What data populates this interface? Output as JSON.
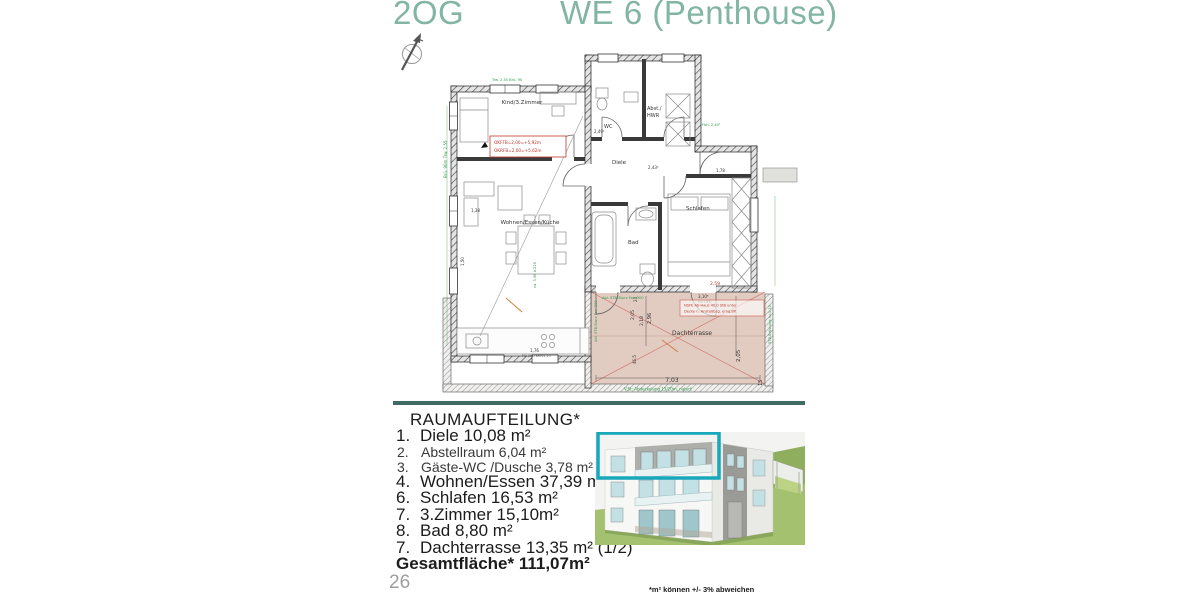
{
  "header": {
    "floor_label": "2OG",
    "unit_label": "WE 6 (Penthouse)"
  },
  "plan": {
    "rooms": {
      "kind": "Kind/3.Zimmer",
      "wc": "WC",
      "abst1": "Abst./",
      "abst2": "HWR",
      "diele": "Diele",
      "wohnen": "Wohnen/Essen/Küche",
      "bad": "Bad",
      "schlafen": "Schlafen",
      "terrasse": "Dachterrasse"
    },
    "level_note": {
      "line1": "OKFFB=2,00=+5,92m",
      "line2": "OKRFB=2,00=+5,62m"
    },
    "terrace_note": {
      "line1": "NSFE Ab-Haus 40,0 StB unter",
      "line2": "Decke n. Anstoßbzg. erng.BP."
    },
    "dims": {
      "d703": "7,03",
      "d205a": "2,05",
      "d205b": "2,05",
      "d296": "2,96",
      "d218": "2,18",
      "d15": "15",
      "d24": "24",
      "d465": "46,5",
      "d259": "2,59",
      "d310": "3,10⁵",
      "mue": "Mü UKD",
      "d178": "1,78",
      "d138": "1,38",
      "d249": "2,49²",
      "d243": "2,43²",
      "d176": "1,76",
      "brh": "Mü UKD BRH/1,25",
      "d150": "1,50"
    },
    "green_notes": {
      "g1": "Brü. 90m Trw. 2,55",
      "g2": "Abl. STB-Sturz Fav. 300",
      "g3": "Abl. STB-Sturz Fav. 300",
      "g4": "V.St: Abdeckelung 15/20m, naturf.",
      "g5": "STB-Brüstung h=1,10",
      "g6": "Fbh. 2,40²",
      "g7": "ca. 3,96 b.225",
      "g8": "Trw. 2,55 Brü. 90"
    }
  },
  "room_list": {
    "heading": "RAUMAUFTEILUNG*",
    "items": [
      {
        "num": "1.",
        "text": "Diele 10,08 m²"
      },
      {
        "num": "2.",
        "text": "Abstellraum 6,04 m²"
      },
      {
        "num": "3.",
        "text": "Gäste-WC /Dusche 3,78 m²"
      },
      {
        "num": "4.",
        "text": "Wohnen/Essen 37,39 m²"
      },
      {
        "num": "6.",
        "text": "Schlafen 16,53 m²"
      },
      {
        "num": "7.",
        "text": "3.Zimmer 15,10m²"
      },
      {
        "num": "8.",
        "text": "Bad 8,80 m²"
      },
      {
        "num": "7.",
        "text": "Dachterrasse 13,35 m² (1/2)"
      }
    ],
    "total": "Gesamtfläche* 111,07m²"
  },
  "footer": {
    "page_number": "26",
    "footnote": "*m² können +/- 3% abweichen"
  },
  "colors": {
    "title_teal": "#83b5a4",
    "divider_teal": "#3f6a64",
    "terrace_fill": "#e2ccc2",
    "dimension_green": "#2e9a47",
    "annotation_red": "#c0392b",
    "highlight_teal": "#18a7bb"
  }
}
